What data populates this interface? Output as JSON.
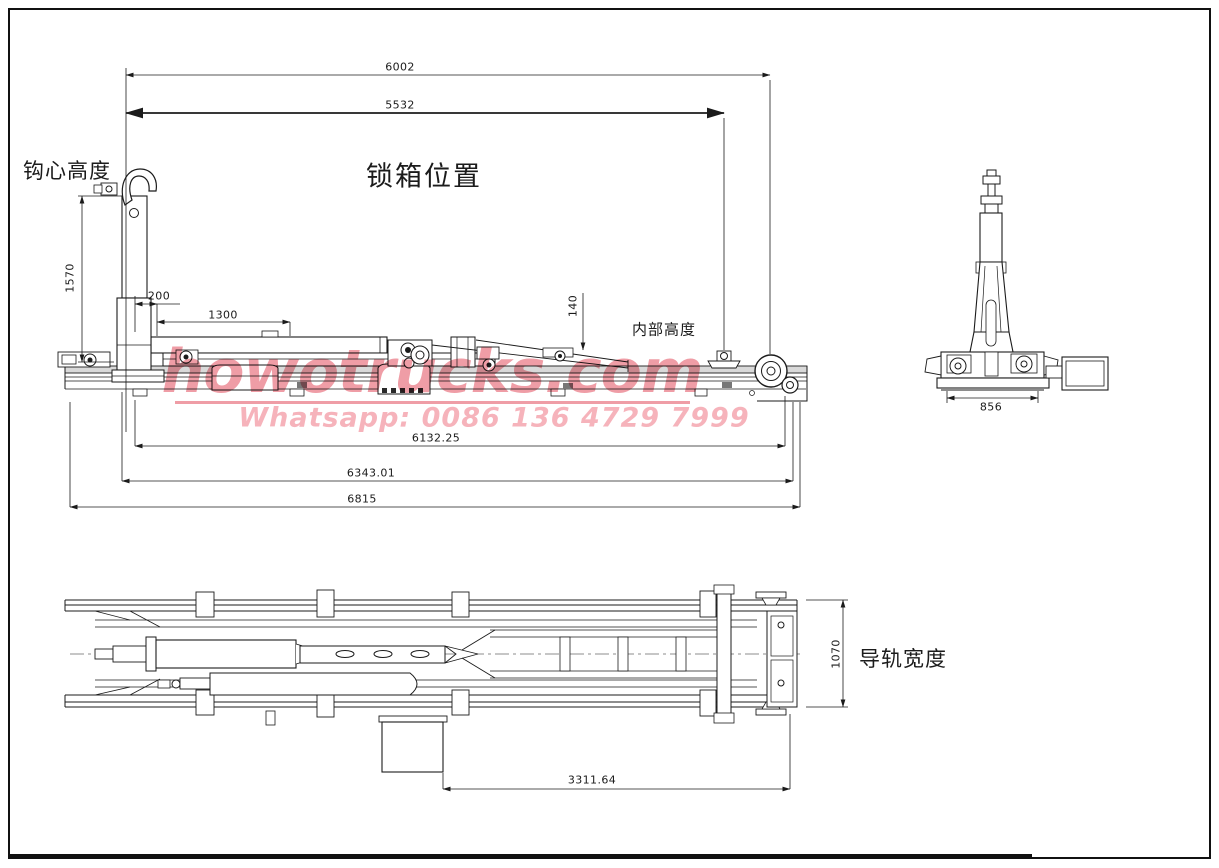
{
  "drawing": {
    "view_labels": {
      "hook_center_height": "钩心高度",
      "lock_box_position": "锁箱位置",
      "internal_height": "内部高度",
      "guide_rail_width": "导轨宽度"
    },
    "dimensions": {
      "overall_top": "6002",
      "lock_span": "5532",
      "hook_height": "1570",
      "hook_offset": "200",
      "front_span": "1300",
      "inner_offset": "140",
      "base_width": "856",
      "frame_length_mid": "6132.25",
      "frame_length_sub": "6343.01",
      "overall_length": "6815",
      "rear_span": "3311.64",
      "rail_width": "1070"
    },
    "watermark": {
      "site": "howotrucks.com",
      "contact": "Whatsapp: 0086 136 4729 7999"
    },
    "colors": {
      "line": "#1b1b1b",
      "rail_fill": "#d9d9d9",
      "watermark_main": "#ef9da6",
      "watermark_sub": "#f6b3bb"
    }
  }
}
